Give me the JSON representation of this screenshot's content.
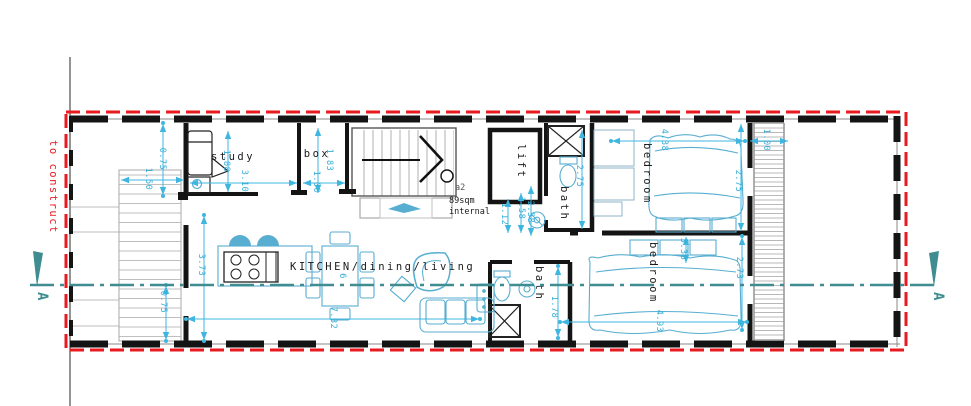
{
  "plan": {
    "site_note": "to construct",
    "section_label": "A",
    "unit": {
      "code": "a2",
      "area": "89sqm",
      "area_note": "internal"
    },
    "rooms": {
      "study": "study",
      "box": "box",
      "lift": "lift",
      "bath_top": "bath",
      "bedroom_top": "bedroom",
      "kitchen": "KITCHEN/dining/living",
      "bath_bottom": "bath",
      "bedroom_bottom": "bedroom"
    },
    "dims": {
      "entry_step": "0.75",
      "stair_width": "1.50",
      "study_depth": "1.88",
      "study_width": "3.10",
      "box_depth": "1.83",
      "box_width": "1.00",
      "hall_a": "1.12",
      "hall_b": "1.58",
      "hall_c": "2.58",
      "bath_top_depth": "2.75",
      "bedroom_top_width": "4.38",
      "bedroom_top_depth": "2.75",
      "terrace_strip": "1.00",
      "living_depth": "3.73",
      "living_width": "7.32",
      "rear_step": "0.75",
      "bath_bottom_depth": "1.78",
      "bedroom_bottom_closet": "3.38",
      "bedroom_bottom_depth": "2.73",
      "bedroom_bottom_width": "4.93",
      "table_seats": "6"
    },
    "colors": {
      "boundary_red": "#e8191f",
      "dimension_cyan": "#3eb6e0",
      "furniture_cyan": "#58aed0",
      "section_teal": "#3f8d90",
      "wall_black": "#141414"
    }
  }
}
